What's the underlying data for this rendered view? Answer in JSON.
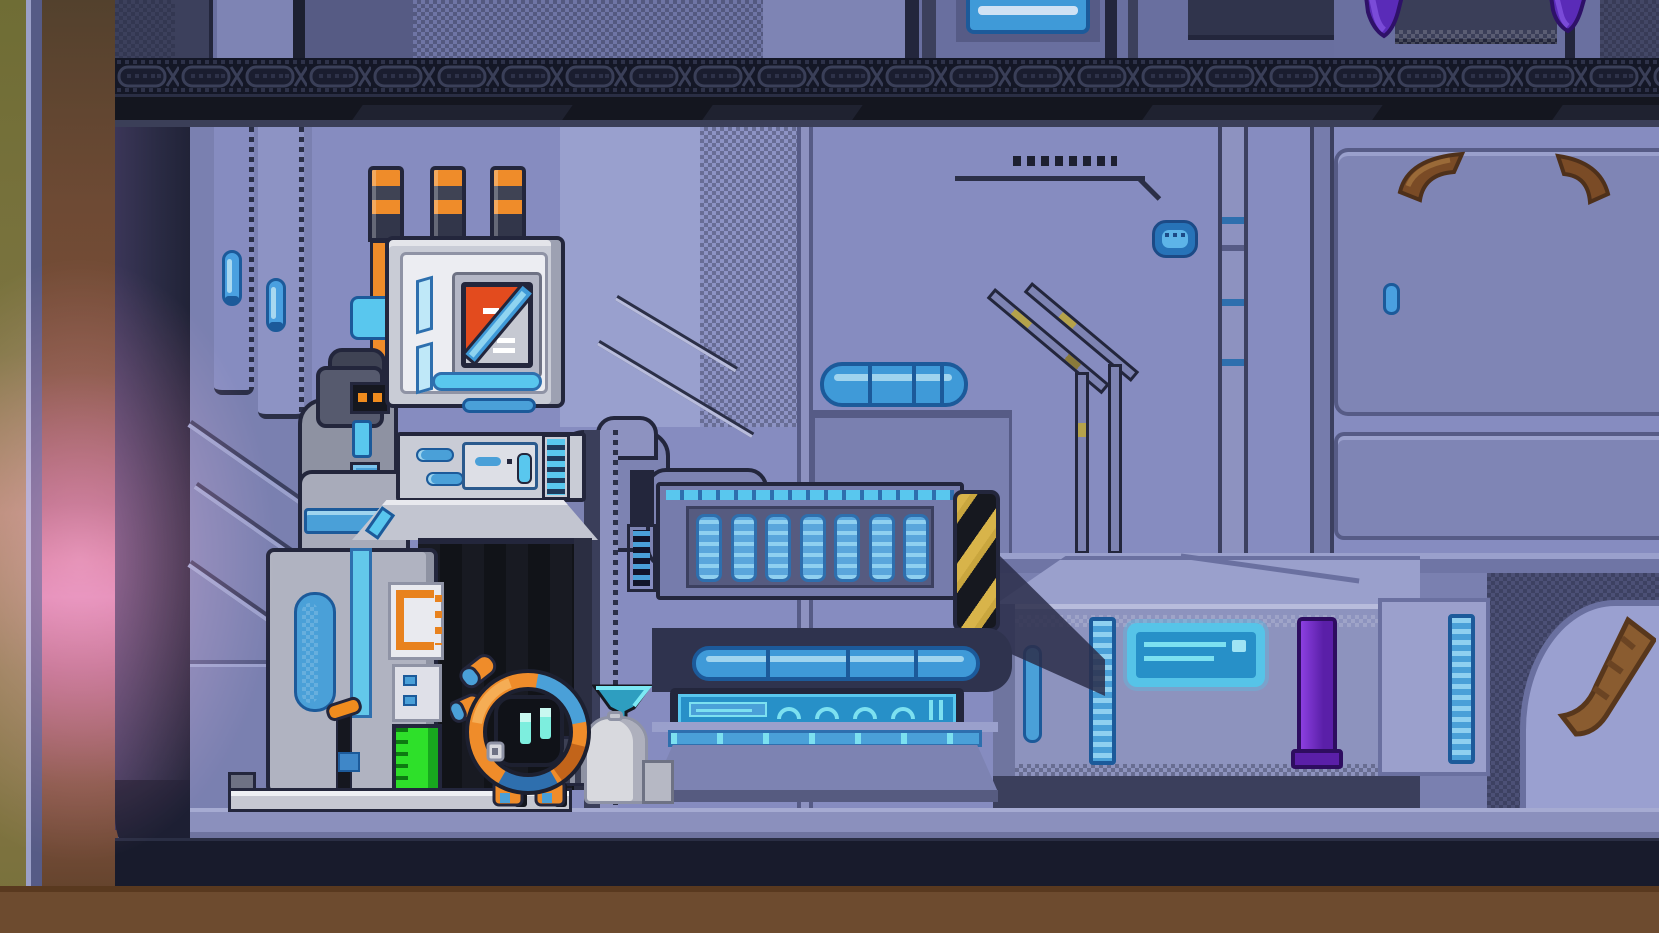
{
  "scene": {
    "title": "Pixel-art space station interior with maintenance robot",
    "style": "pixel-art side-scroller room",
    "viewport": {
      "width": 1659,
      "height": 933
    },
    "visible_text": "none"
  },
  "palette": {
    "wall": "#868cc0",
    "wall_light": "#99a0ce",
    "wall_dark": "#767cac",
    "wall_deep": "#565b86",
    "outline": "#23263c",
    "ceiling_black": "#14161f",
    "truss_band": "#141726",
    "accent_cyan": "#59c7ee",
    "accent_blue": "#3f9ad8",
    "deep_blue": "#1c5a9a",
    "pale_blue": "#9fd4ee",
    "machine_light": "#c9ccd6",
    "machine_mid": "#b0b3c1",
    "machine_dark": "#8e92a2",
    "orange": "#ef8c2a",
    "orange_deep": "#c05f10",
    "emblem_red": "#e34b1e",
    "gauge_green": "#2ee02a",
    "hazard_yellow": "#c9a63e",
    "hazard_black": "#16181f",
    "crate_top": "#9aa0cc",
    "crate_front": "#8d93be",
    "purple_bar": "#5a1fa8",
    "purple_bar_light": "#8b3fe0",
    "tentacle_purple": "#5a2bb8",
    "root_brown": "#8a5c30",
    "floor_top": "#8b90bd",
    "floor_dark": "#181b2c",
    "floor_soil": "#6d4b2f",
    "exterior_olive": "#6f6d35",
    "exterior_brown": "#6e4a34",
    "glow_pink": "#d978a2"
  },
  "counts": {
    "radiator_slats": 7,
    "screen_arches": 4,
    "chimneys": 3
  },
  "entities": [
    {
      "id": "exterior-light-column",
      "label": "exterior gap with pink light glow",
      "color": "#d978a2"
    },
    {
      "id": "ceiling-truss",
      "label": "dark girder truss band under upper deck",
      "color": "#141726"
    },
    {
      "id": "upper-deck-window",
      "label": "blue window on upper deck",
      "color": "#3f9ad8"
    },
    {
      "id": "purple-tentacles",
      "label": "purple growths hanging from ceiling",
      "color": "#5a2bb8"
    },
    {
      "id": "reactor-machine",
      "label": "grey reactor machine with 3 striped chimneys, emblem screen, control panel and dark doorway",
      "color": "#c9ccd6"
    },
    {
      "id": "emblem-display",
      "label": "screen showing orange/white diagonal emblem",
      "color": "#e34b1e"
    },
    {
      "id": "green-level-gauge",
      "label": "green level gauge on machine base",
      "color": "#2ee02a"
    },
    {
      "id": "robot-character",
      "label": "small round orange robot with cyan eyes",
      "color": "#ef8c2a"
    },
    {
      "id": "trash-bag",
      "label": "grey sack beside robot",
      "color": "#d8d9de"
    },
    {
      "id": "cyan-funnel",
      "label": "cyan funnel on workbench edge",
      "color": "#59c7ee"
    },
    {
      "id": "wall-radiator",
      "label": "blue slatted radiator vent",
      "color": "#5aa6dc"
    },
    {
      "id": "workbench",
      "label": "workbench with glowing blue strip light and readout",
      "color": "#2790c8"
    },
    {
      "id": "hazard-post",
      "label": "yellow/black hazard striped post",
      "color": "#c9a63e"
    },
    {
      "id": "wall-pipes",
      "label": "wall piping with yellow worn patches",
      "color": "#b5a24b"
    },
    {
      "id": "blue-tank",
      "label": "horizontal blue tank on wall",
      "color": "#3f9ad8"
    },
    {
      "id": "supply-crate",
      "label": "large crate with glowing label and purple light bar",
      "color": "#8d93be"
    },
    {
      "id": "purple-light-bar",
      "label": "vertical purple glow bar on crate",
      "color": "#8b3fe0"
    },
    {
      "id": "brown-roots",
      "label": "brown roots breaking through right wall",
      "color": "#8a5c30"
    },
    {
      "id": "floor-walkway",
      "label": "metal walkway floor over soil",
      "color": "#8b90bd"
    }
  ]
}
